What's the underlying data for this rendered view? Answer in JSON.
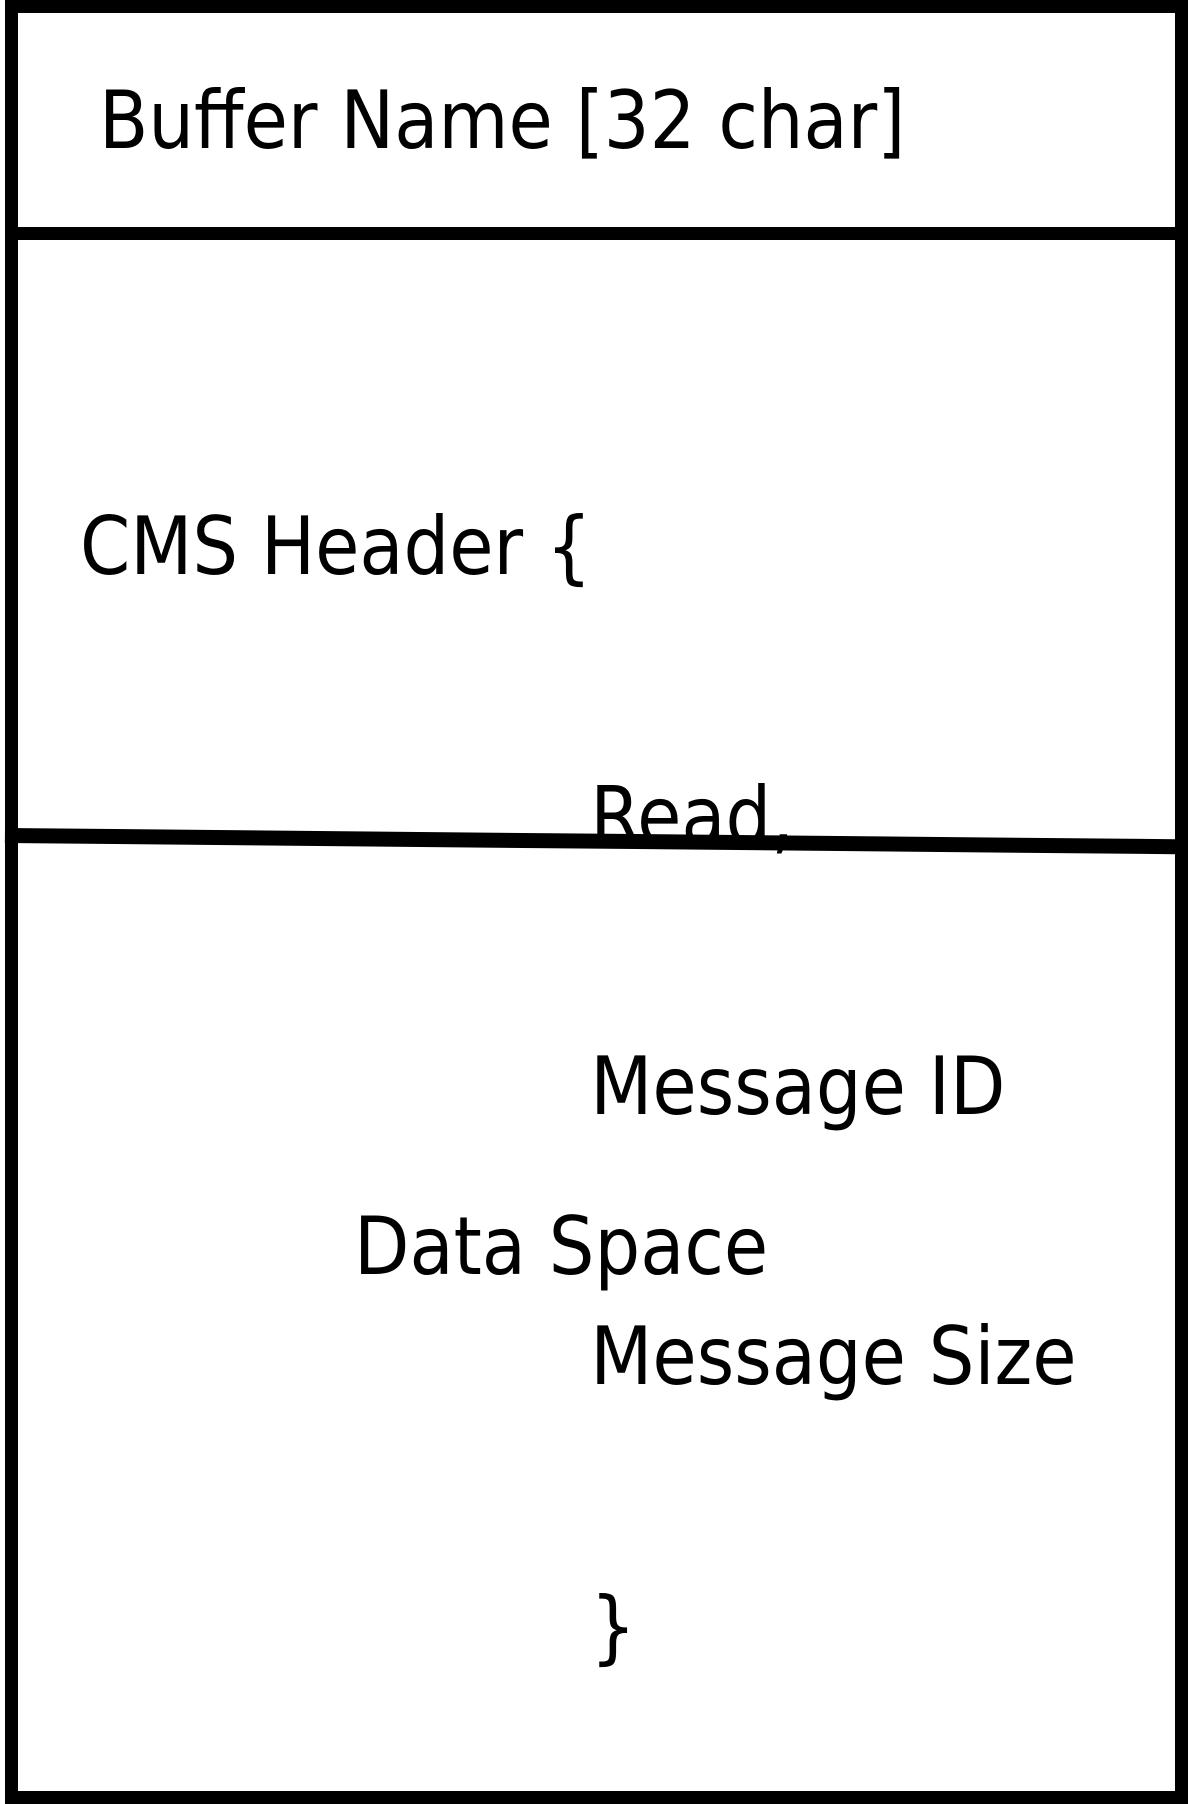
{
  "colors": {
    "ink": "#000000",
    "background": "#ffffff"
  },
  "diagram": {
    "buffer_name_label": "Buffer Name [32 char]",
    "cms_header": {
      "open": "CMS Header {",
      "fields": [
        "Read,",
        "Message ID",
        "Message Size"
      ],
      "close": "}"
    },
    "data_space_label": "Data Space"
  }
}
